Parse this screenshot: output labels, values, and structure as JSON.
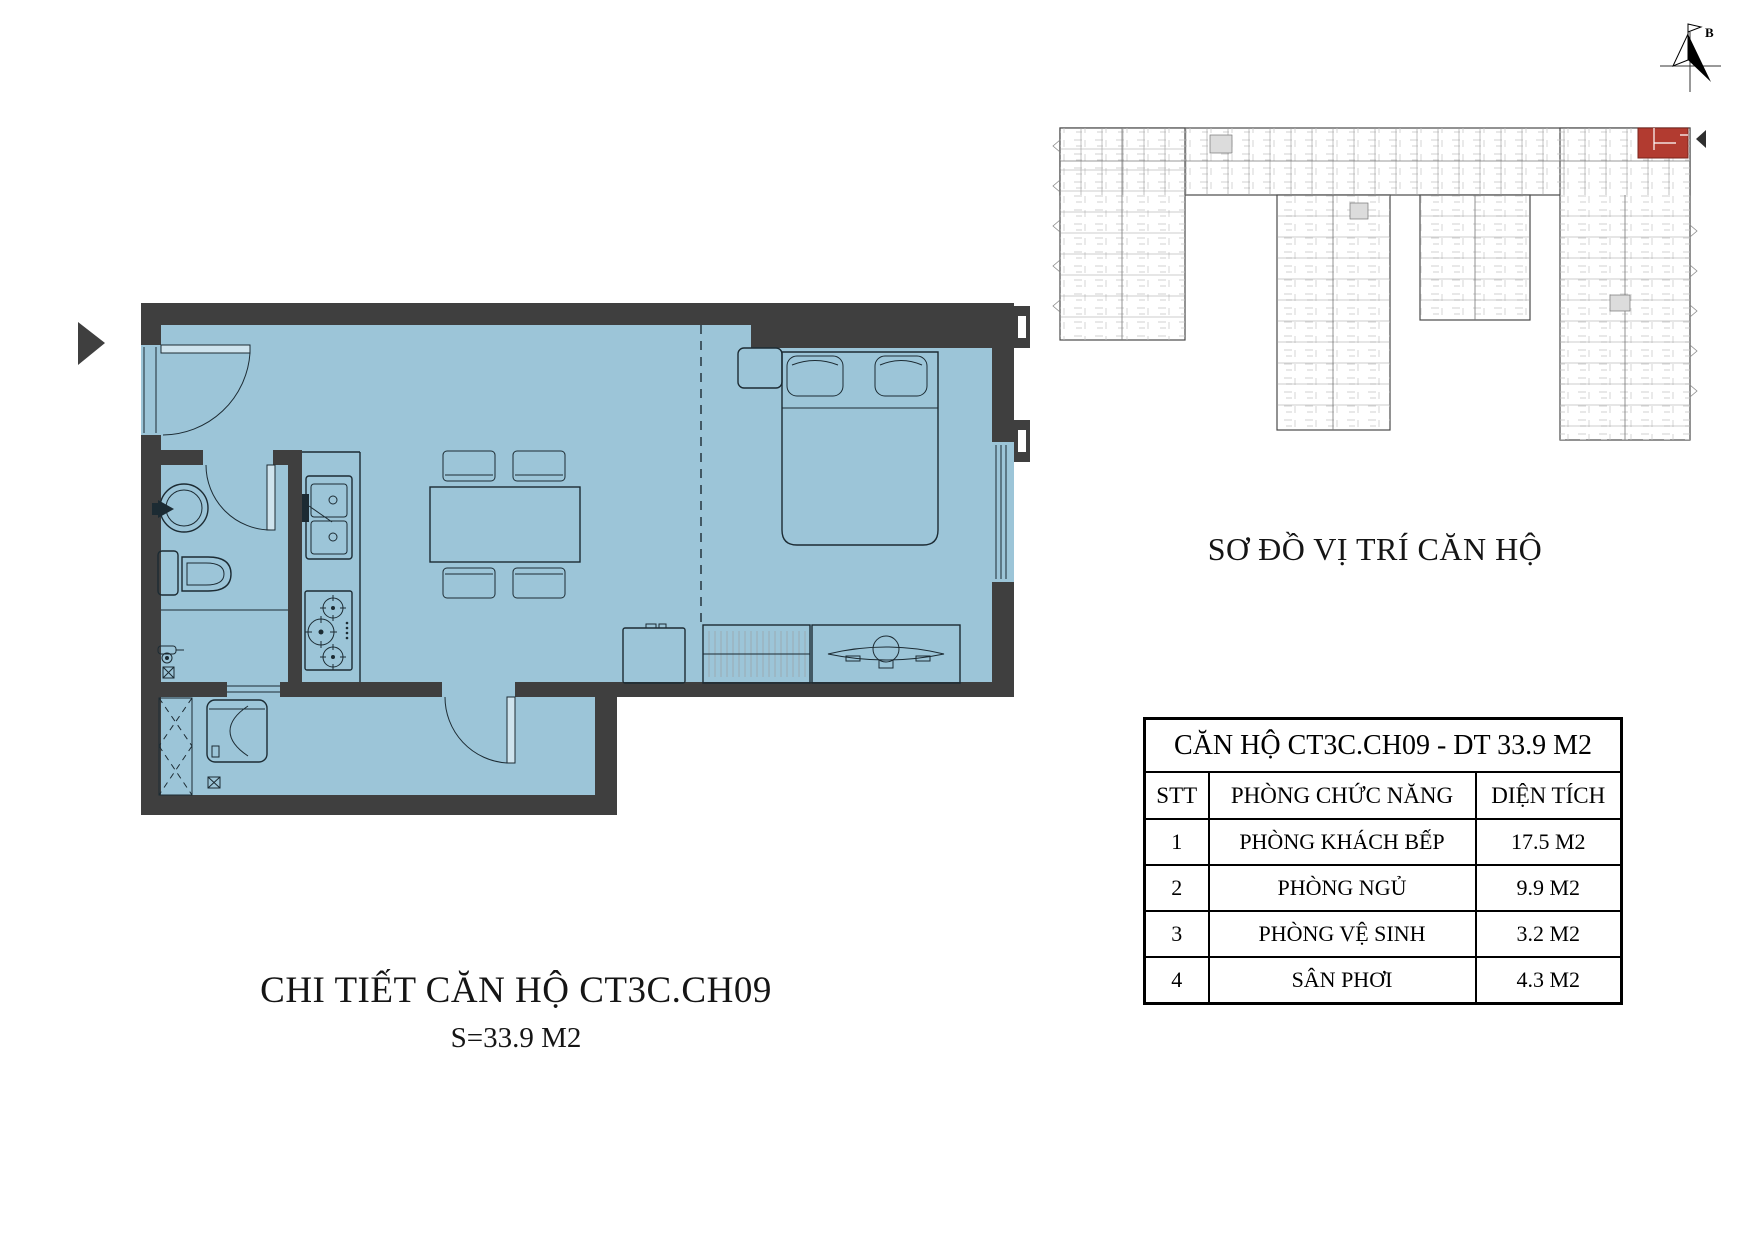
{
  "theme": {
    "floor": "#9cc5d8",
    "wall": "#3f3f3f",
    "line": "#1c2b33",
    "door_leaf": "#cfe4ee",
    "highlight_red": "#b23b30"
  },
  "detail_plan": {
    "title": "CHI TIẾT CĂN HỘ CT3C.CH09",
    "area_label": "S=33.9 M2"
  },
  "location_diagram": {
    "title": "SƠ ĐỒ VỊ TRÍ CĂN HỘ",
    "north_label": "B"
  },
  "info_table": {
    "title": "CĂN HỘ CT3C.CH09 - DT 33.9 M2",
    "columns": [
      "STT",
      "PHÒNG CHỨC NĂNG",
      "DIỆN TÍCH"
    ],
    "rows": [
      [
        "1",
        "PHÒNG KHÁCH BẾP",
        "17.5 M2"
      ],
      [
        "2",
        "PHÒNG NGỦ",
        "9.9 M2"
      ],
      [
        "3",
        "PHÒNG VỆ SINH",
        "3.2 M2"
      ],
      [
        "4",
        "SÂN PHƠI",
        "4.3 M2"
      ]
    ]
  }
}
